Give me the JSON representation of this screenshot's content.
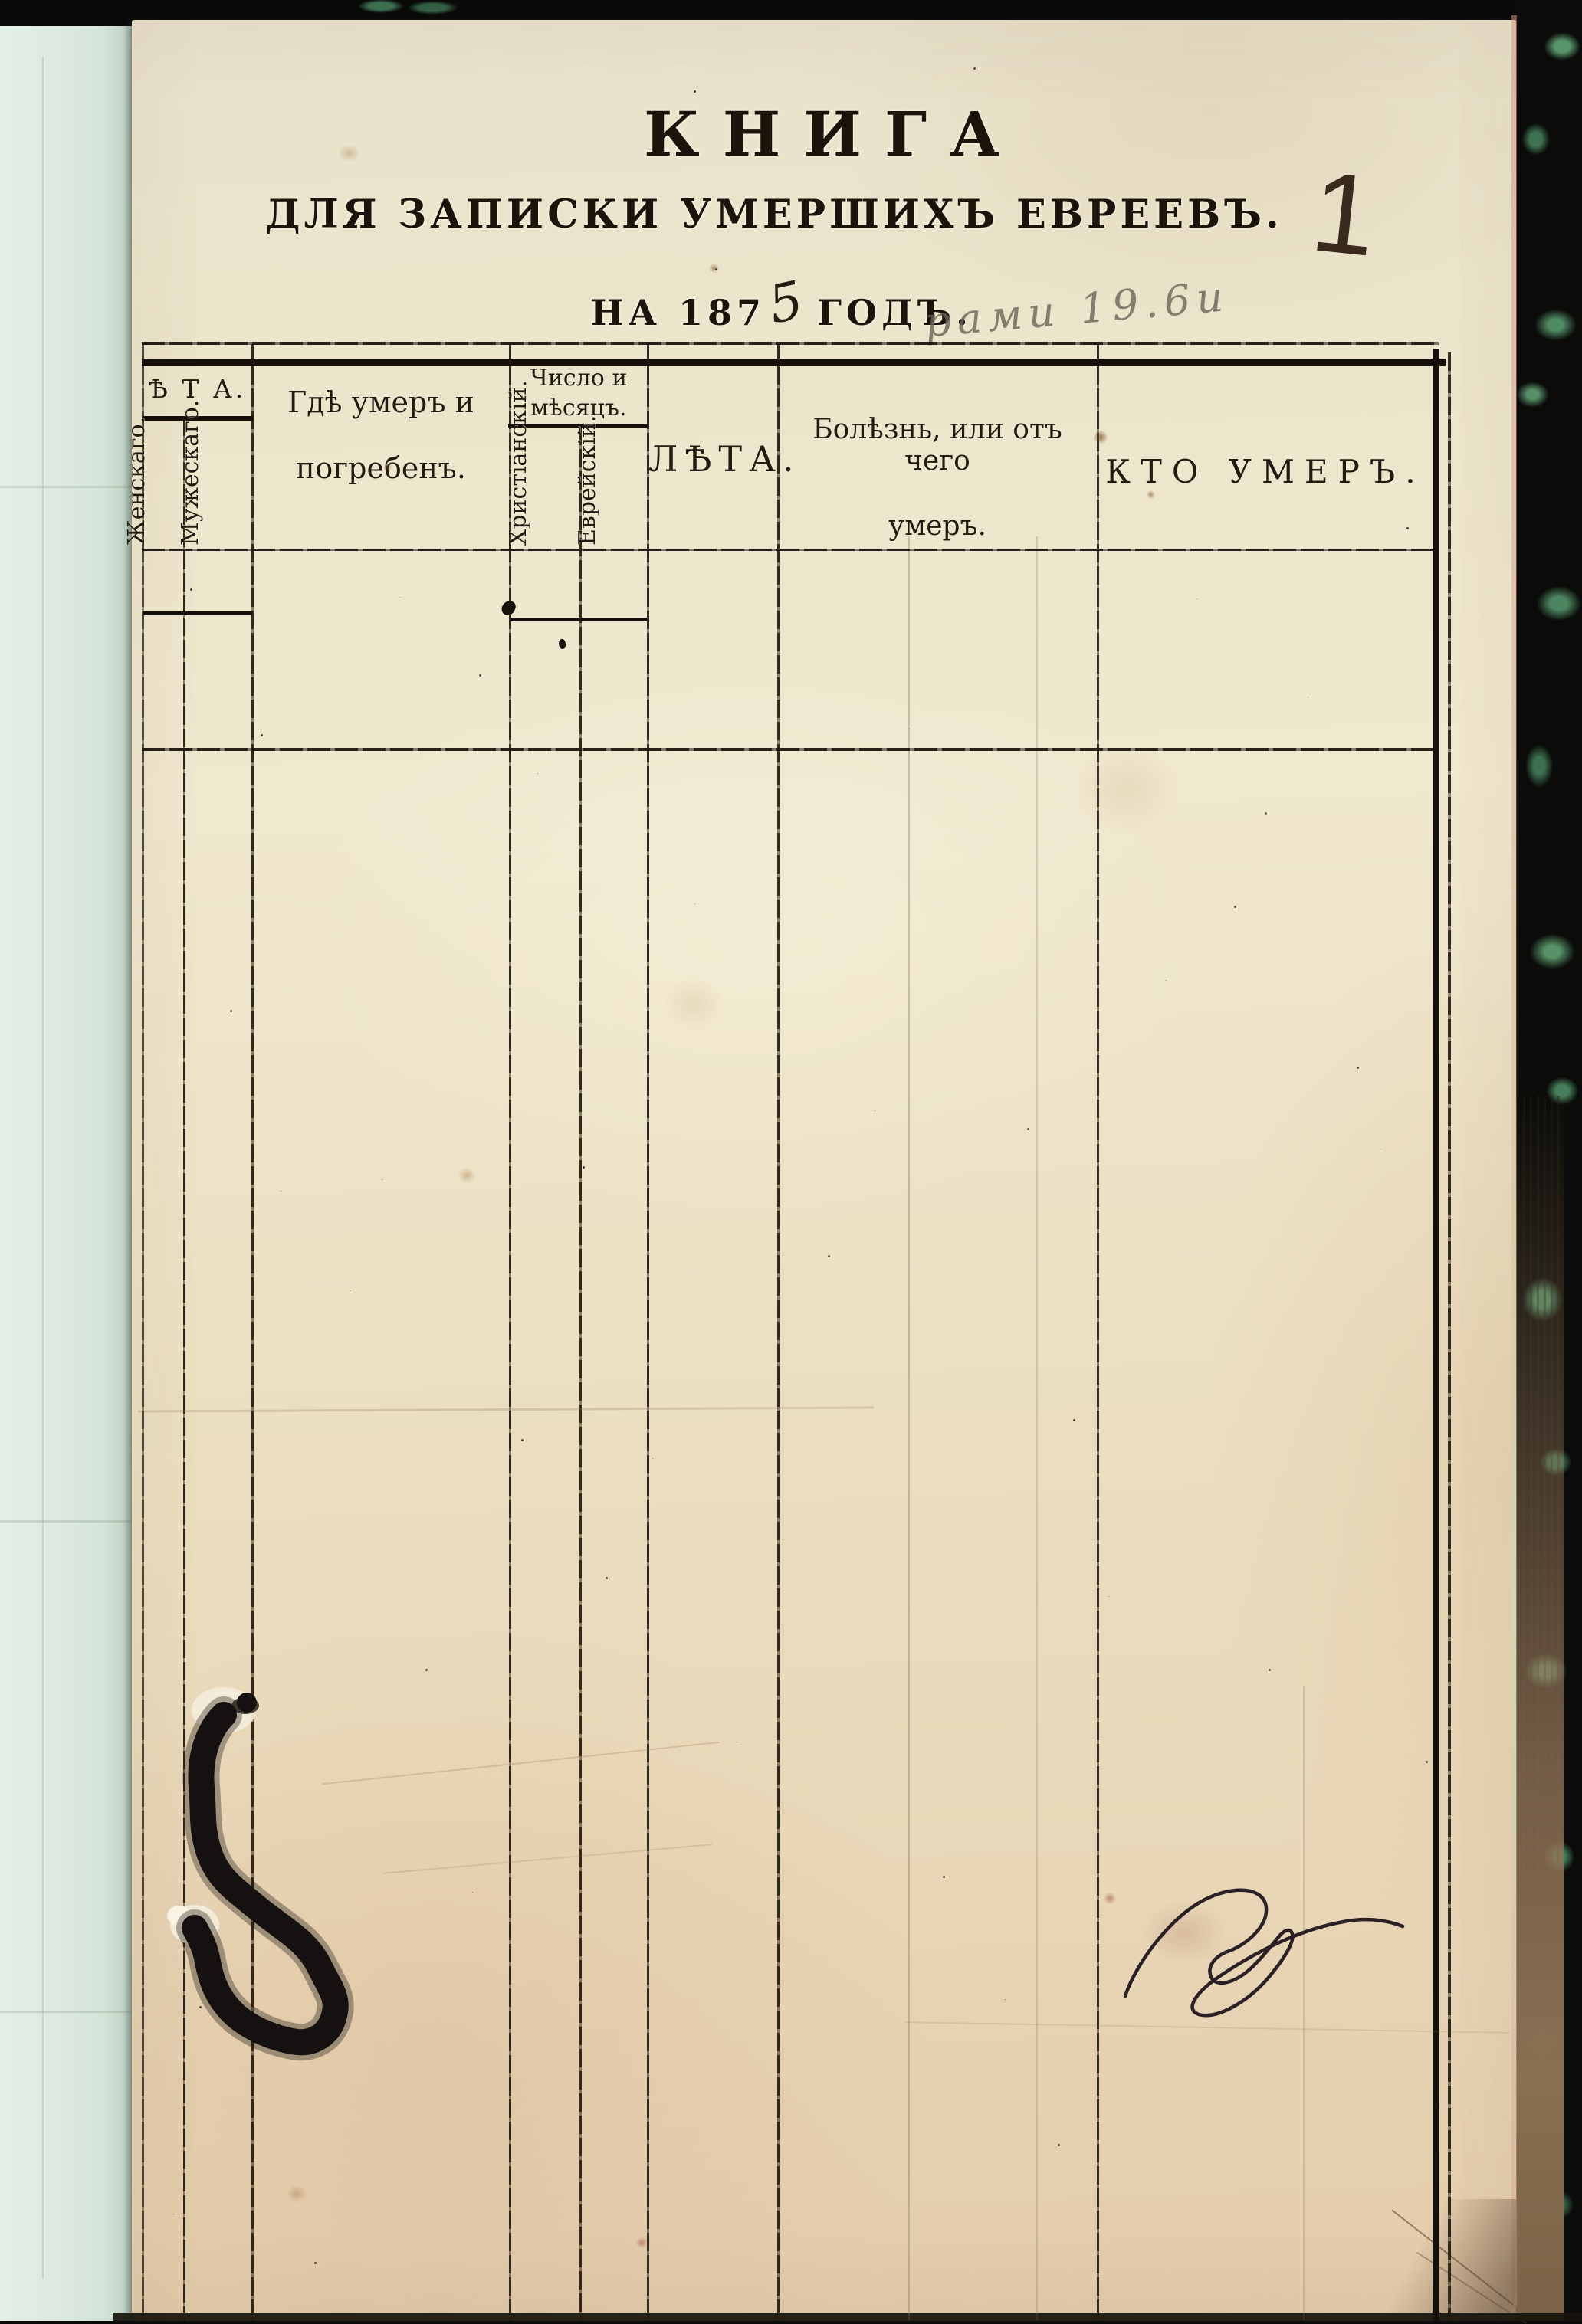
{
  "page": {
    "title": "КНИГА",
    "subtitle": "ДЛЯ ЗАПИСКИ УМЕРШИХЪ ЕВРЕЕВЪ.",
    "year_prefix": "НА 187",
    "year_handwritten_digit": "5",
    "year_suffix": "ГОДЪ.",
    "page_number": "1",
    "pencil_note": "рами 19.6и"
  },
  "table": {
    "group_age_label": "Ѣ Т А.",
    "group_date_line1": "Число и",
    "group_date_line2": "мѣсяцъ.",
    "col_female": "Женскаго.",
    "col_male": "Мужескаго.",
    "col_where_line1": "Гдѣ умеръ и",
    "col_where_line2": "погребенъ.",
    "col_date_christian": "Христіанскій.",
    "col_date_jewish": "Еврейскій.",
    "col_age": "ЛѢТА.",
    "col_cause_line1": "Болѣзнь, или отъ чего",
    "col_cause_line2": "умеръ.",
    "col_who": "КТО УМЕРЪ."
  },
  "colors": {
    "paper": "#ece3c7",
    "facing_page": "#dfeadf",
    "cover_black": "#0b0c09",
    "cover_green": "#4f8a63",
    "ink": "#1c140b",
    "pencil": "#6a6356",
    "table_line": "#201910"
  }
}
